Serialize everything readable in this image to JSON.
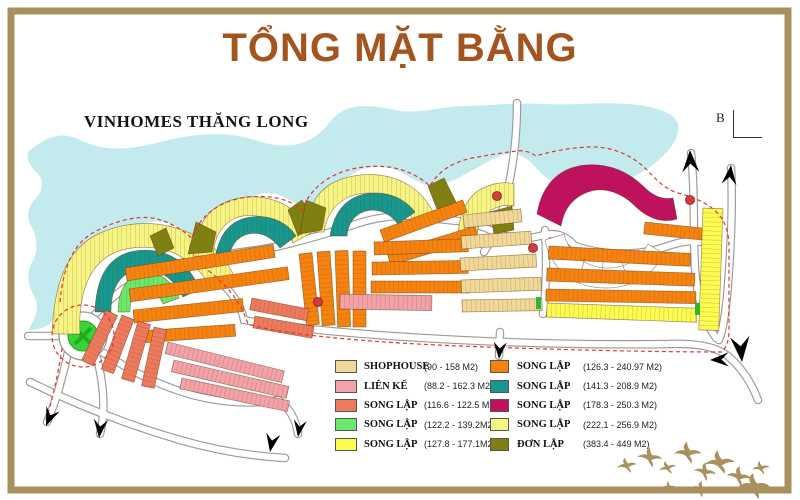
{
  "page": {
    "title": "TỔNG MẶT BẰNG",
    "title_color": "#a3541f",
    "frame_color": "#a8915c"
  },
  "map": {
    "project_label": "VINHOMES THĂNG LONG",
    "section_marker": "B",
    "water_color": "#c3ebee",
    "boundary_color": "#e03535",
    "road_outline_color": "#9a9a9a",
    "roundabout_color": "#38d438"
  },
  "legend": {
    "columns": [
      {
        "items": [
          {
            "name": "SHOPHOUSE",
            "range": "(90 - 158 M2)",
            "color": "#f0d898"
          },
          {
            "name": "LIÊN KẾ",
            "range": "(88.2 - 162.3 M2)",
            "color": "#f2a2a8"
          },
          {
            "name": "SONG LẬP",
            "range": "(116.6 - 122.5 M2)",
            "color": "#ee7a5e"
          },
          {
            "name": "SONG LẬP",
            "range": "(122.2 - 139.2M2)",
            "color": "#6ce86c"
          },
          {
            "name": "SONG LẬP",
            "range": "(127.8 - 177.1M2)",
            "color": "#fbfb52"
          }
        ]
      },
      {
        "items": [
          {
            "name": "SONG LẬP",
            "range": "(126.3 - 240.97 M2)",
            "color": "#f6830f"
          },
          {
            "name": "SONG LẬP",
            "range": "(141.3 - 208.9 M2)",
            "color": "#17988f"
          },
          {
            "name": "SONG LẬP",
            "range": "(178.3 - 250.3 M2)",
            "color": "#c11060"
          },
          {
            "name": "SONG LẬP",
            "range": "(222.1 - 256.9 M2)",
            "color": "#f6f584"
          },
          {
            "name": "ĐƠN LẬP",
            "range": "(383.4 - 449 M2)",
            "color": "#7f7f12"
          }
        ]
      }
    ]
  }
}
